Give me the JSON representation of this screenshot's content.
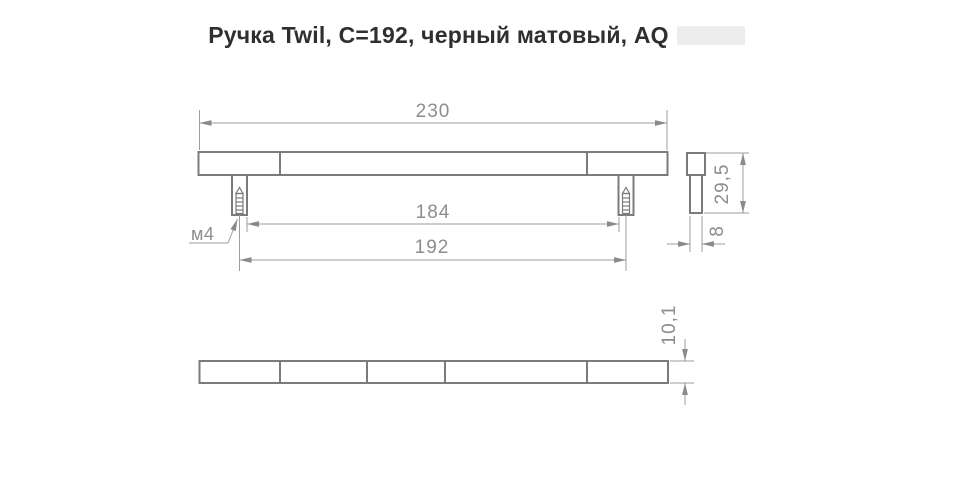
{
  "title": {
    "text": "Ручка Twil, C=192, черный матовый, AQ"
  },
  "drawing": {
    "front_view": {
      "overall_length": "230",
      "inner_distance": "184",
      "mounting_distance": "192",
      "thread": "м4"
    },
    "side_view": {
      "total_height": "29,5",
      "bar_width": "8"
    },
    "plan_view": {
      "bar_thickness": "10,1"
    }
  },
  "colors": {
    "outline_line": "#7b7b7b",
    "dimension_line": "#9c9c9c",
    "dimension_text": "#8d8d8d",
    "title_text": "#2f2f2f",
    "badge_bg": "#ededed"
  }
}
